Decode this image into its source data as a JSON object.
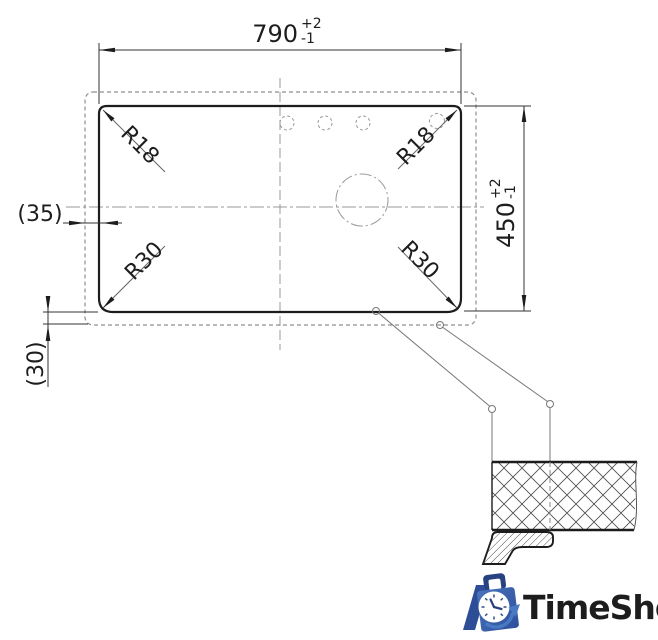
{
  "drawing": {
    "dimensions": {
      "width": {
        "value": "790",
        "tol_plus": "+2",
        "tol_minus": "-1"
      },
      "height": {
        "value": "450",
        "tol_plus": "+2",
        "tol_minus": "-1"
      },
      "side_offset": "(35)",
      "bottom_offset": "(30)"
    },
    "radii": {
      "top_left": "R18",
      "top_right": "R18",
      "bottom_left": "R30",
      "bottom_right": "R30"
    },
    "colors": {
      "solid_line": "#1d1d1d",
      "dim_line": "#333333",
      "hidden_line": "#8f8f8f",
      "centerline": "#9a9a9a"
    }
  },
  "logo": {
    "text": "TimeShop",
    "text_color": "#5688cb",
    "bag_color": "#3a60ab",
    "bag_dark": "#27427f"
  }
}
